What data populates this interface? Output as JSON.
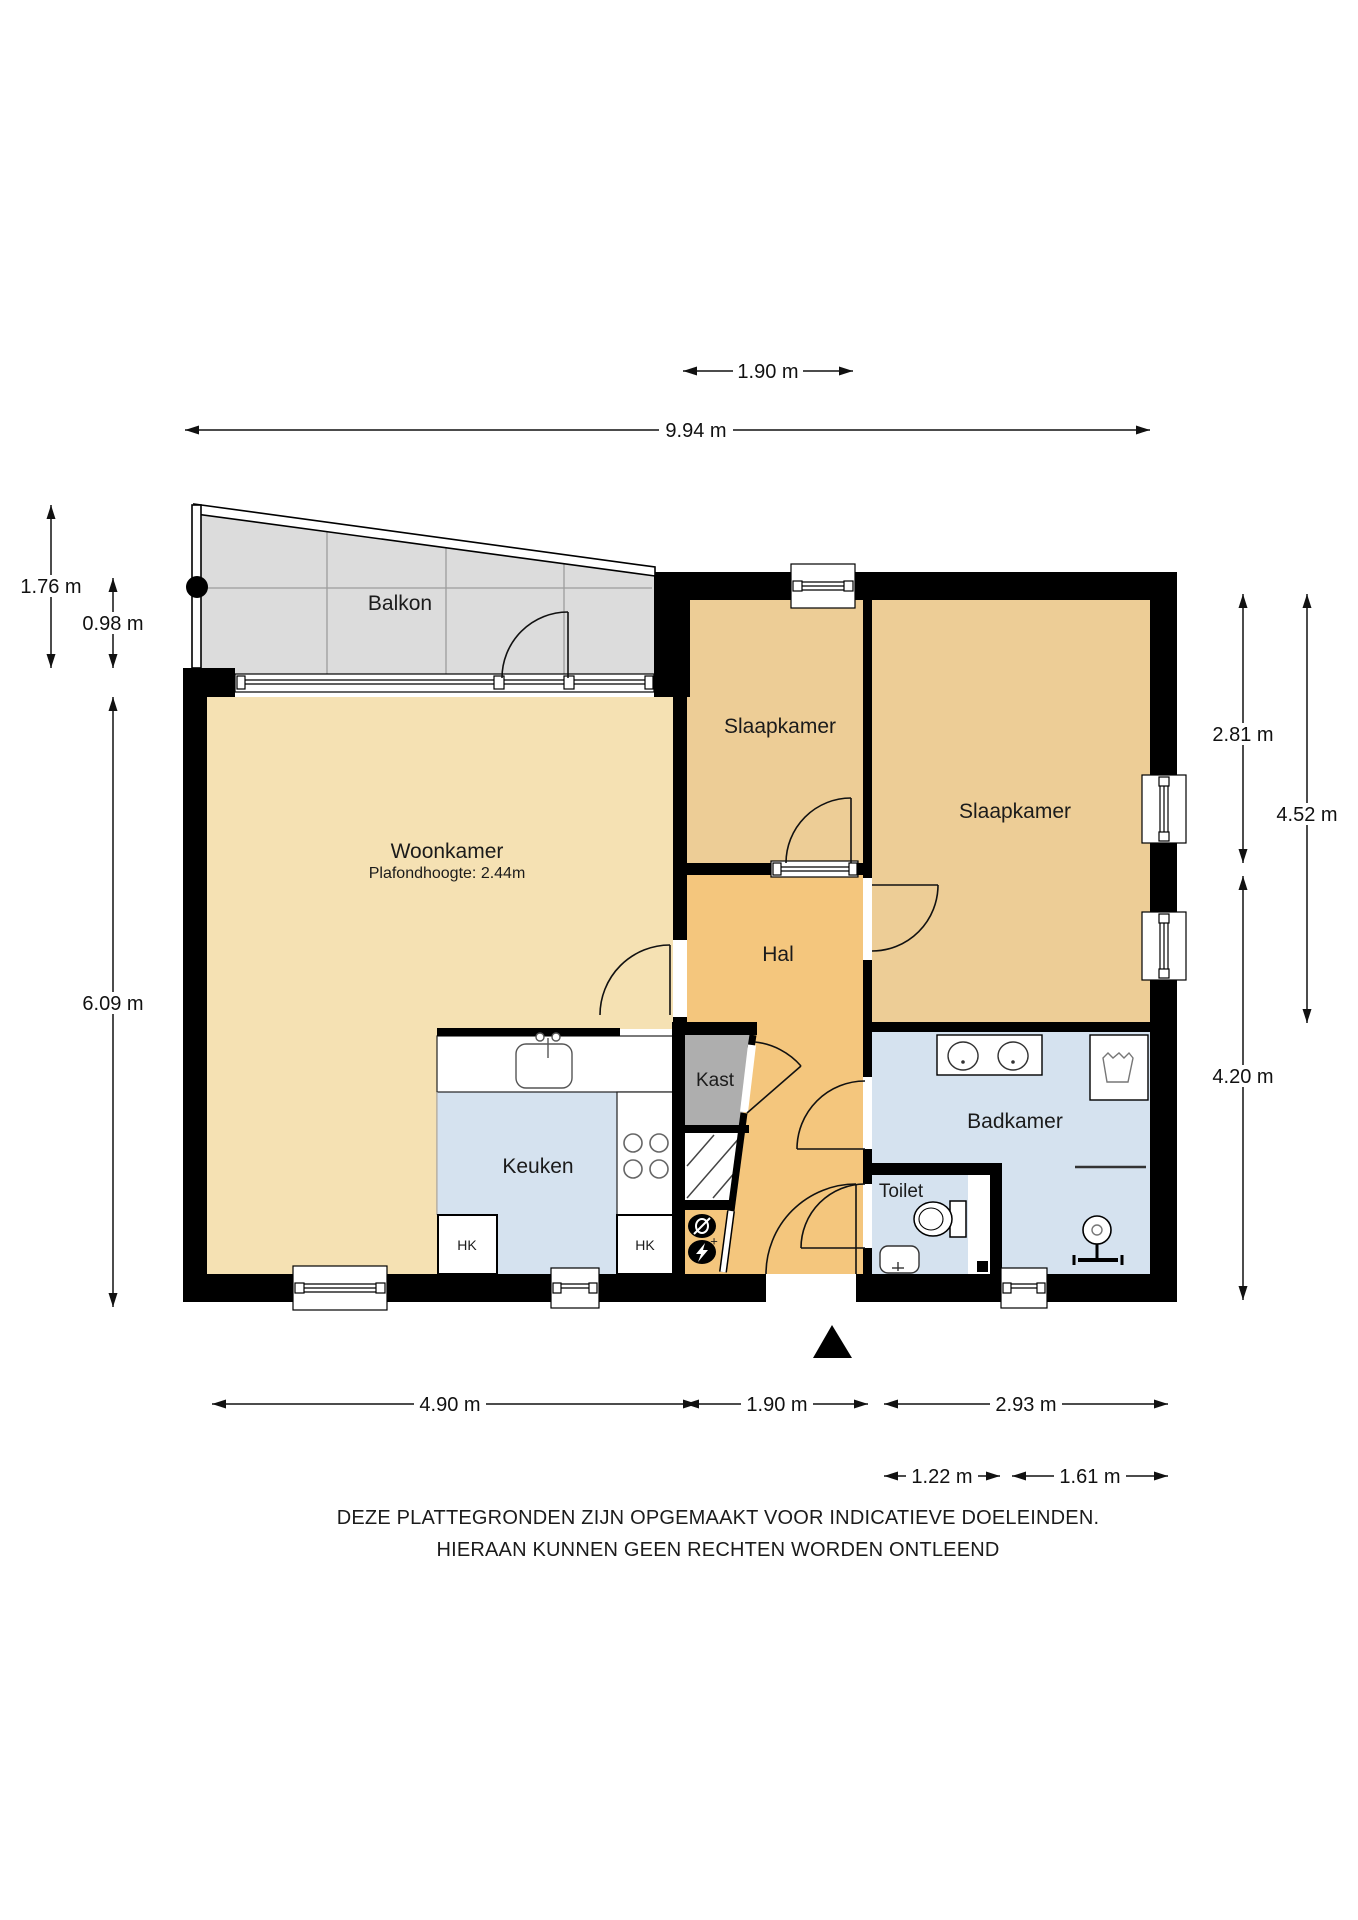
{
  "floorplan": {
    "rooms": {
      "balkon": {
        "label": "Balkon"
      },
      "woonkamer": {
        "label": "Woonkamer",
        "sub": "Plafondhoogte: 2.44m"
      },
      "slaapkamer1": {
        "label": "Slaapkamer"
      },
      "slaapkamer2": {
        "label": "Slaapkamer"
      },
      "hal": {
        "label": "Hal"
      },
      "kast": {
        "label": "Kast"
      },
      "keuken": {
        "label": "Keuken"
      },
      "badkamer": {
        "label": "Badkamer"
      },
      "toilet": {
        "label": "Toilet"
      },
      "hk1": {
        "label": "HK"
      },
      "hk2": {
        "label": "HK"
      }
    },
    "dimensions": {
      "top_190": {
        "label": "1.90 m"
      },
      "top_994": {
        "label": "9.94 m"
      },
      "left_176": {
        "label": "1.76 m"
      },
      "left_098": {
        "label": "0.98 m"
      },
      "left_609": {
        "label": "6.09 m"
      },
      "right_281": {
        "label": "2.81 m"
      },
      "right_452": {
        "label": "4.52 m"
      },
      "right_420": {
        "label": "4.20 m"
      },
      "bot_490": {
        "label": "4.90 m"
      },
      "bot_190": {
        "label": "1.90 m"
      },
      "bot_293": {
        "label": "2.93 m"
      },
      "bot_122": {
        "label": "1.22 m"
      },
      "bot_161": {
        "label": "1.61 m"
      }
    },
    "disclaimer": {
      "line1": "DEZE PLATTEGRONDEN ZIJN OPGEMAAKT VOOR INDICATIEVE DOELEINDEN.",
      "line2": "HIERAAN KUNNEN GEEN RECHTEN WORDEN ONTLEEND"
    },
    "colors": {
      "wall": "#000000",
      "woonkamer": "#F5E1B3",
      "slaapkamer": "#EDCD96",
      "hal": "#F4C67D",
      "kast": "#AEAEAE",
      "wet_rooms": "#D5E2EF",
      "balkon": "#DCDCDC"
    }
  }
}
